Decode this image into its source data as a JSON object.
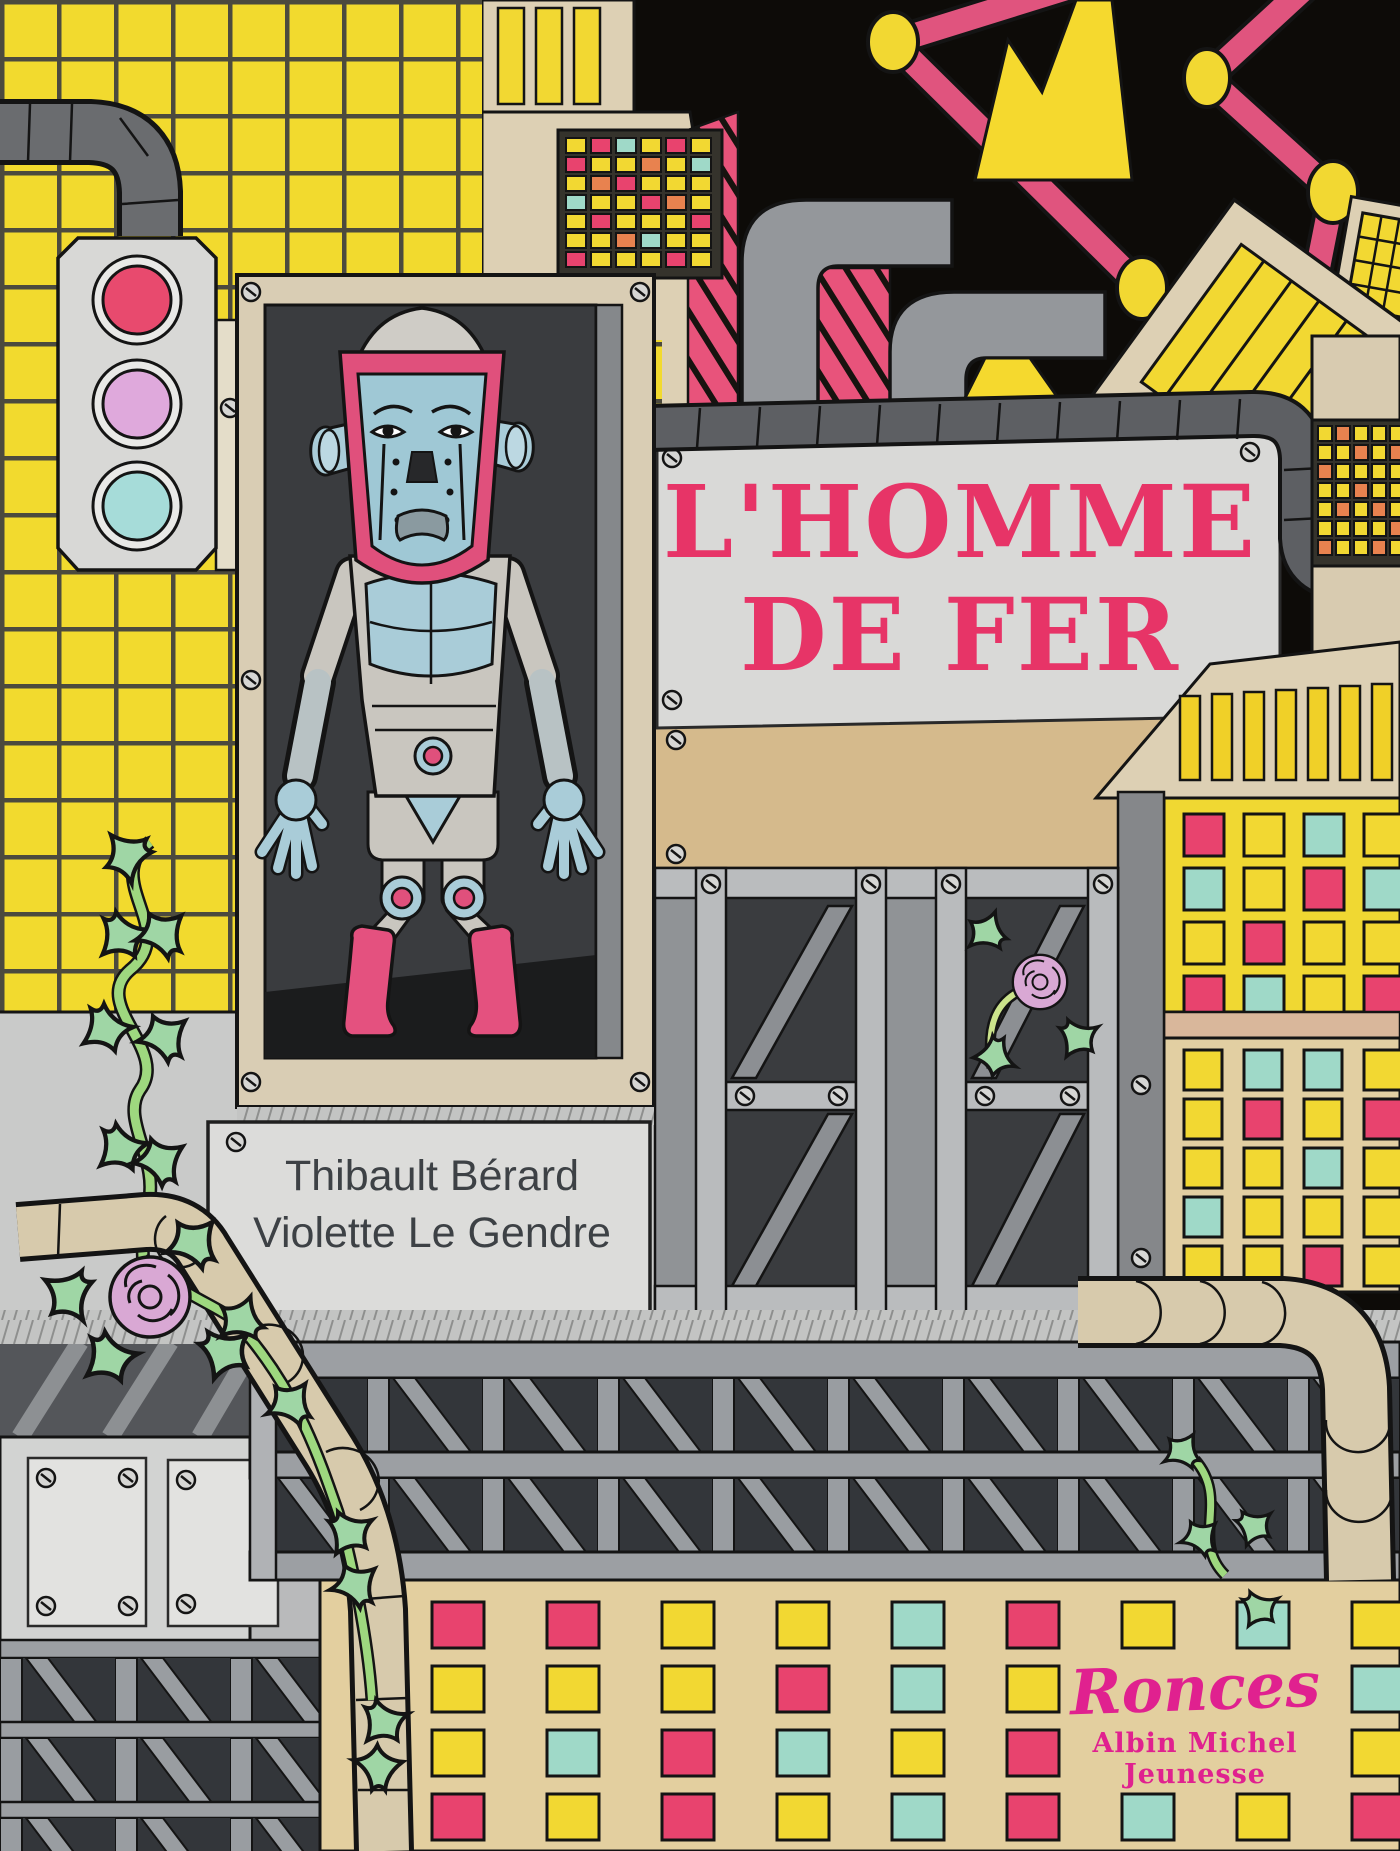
{
  "book_cover": {
    "title": {
      "line1": "L'HOMME",
      "line2": "DE FER"
    },
    "authors": [
      "Thibault Bérard",
      "Violette Le Gendre"
    ],
    "collection_logo": "Ronces",
    "imprint": "Albin Michel Jeunesse",
    "colors": {
      "title_pink": "#e73467",
      "logo_magenta": "#e0218f",
      "author_gray": "#3d4145",
      "accent_yellow": "#f2d832",
      "accent_pink": "#e8436e",
      "accent_teal": "#9fd9c8",
      "traffic_lilac": "#dfa9dc",
      "robot_blue": "#a9ccd8",
      "boot_pink": "#e4517f",
      "wall_beige": "#ddd0b4",
      "sky_black": "#0d0b08"
    }
  },
  "scene": {
    "elements": [
      "yellow-tiled-wall",
      "traffic-light",
      "overhead-pipe",
      "robot-display-cabinet",
      "iron-man-robot",
      "title-sign",
      "factory-chimneys",
      "constellation-crane-arms",
      "tilted-slat-crate",
      "author-name-plate",
      "x-braced-doors",
      "climbing-rose-vine",
      "rose-flowers",
      "steel-truss-bridge",
      "beige-pipes",
      "colored-window-walls",
      "mosaic-tile-panels"
    ],
    "palette_map": {
      "p": "#e8436e",
      "y": "#f2d832",
      "t": "#9fd9c8",
      "o": "#e8824f"
    },
    "square_grids": {
      "bottom-wall": {
        "origin": [
          432,
          1602
        ],
        "cell": [
          52,
          46
        ],
        "step": [
          115,
          64
        ],
        "stroke": 3,
        "rows": [
          [
            "p",
            "p",
            "y",
            "y",
            "t",
            "p",
            "y",
            "t",
            "y"
          ],
          [
            "y",
            "y",
            "y",
            "p",
            "t",
            "y",
            "",
            "",
            "t"
          ],
          [
            "y",
            "t",
            "p",
            "t",
            "y",
            "p",
            "",
            "",
            "y"
          ],
          [
            "p",
            "y",
            "p",
            "y",
            "t",
            "p",
            "t",
            "y",
            "p"
          ]
        ]
      },
      "right-yellow-wall": {
        "origin": [
          1184,
          814
        ],
        "cell": [
          40,
          42
        ],
        "step": [
          60,
          54
        ],
        "stroke": 3,
        "rows": [
          [
            "p",
            "y",
            "t",
            "y"
          ],
          [
            "t",
            "y",
            "p",
            "t"
          ],
          [
            "y",
            "p",
            "y",
            "y"
          ],
          [
            "p",
            "t",
            "y",
            "p"
          ]
        ]
      },
      "right-beige-wall": {
        "origin": [
          1184,
          1050
        ],
        "cell": [
          38,
          40
        ],
        "step": [
          60,
          49
        ],
        "stroke": 3,
        "rows": [
          [
            "y",
            "t",
            "t",
            "y"
          ],
          [
            "y",
            "p",
            "y",
            "p"
          ],
          [
            "y",
            "y",
            "t",
            "y"
          ],
          [
            "t",
            "y",
            "y",
            "y"
          ],
          [
            "y",
            "y",
            "p",
            "y"
          ]
        ]
      },
      "tower-mosaic": {
        "origin": [
          566,
          138
        ],
        "cell": [
          20,
          15
        ],
        "step": [
          25,
          19
        ],
        "stroke": 2,
        "rows": [
          [
            "y",
            "p",
            "t",
            "y",
            "p",
            "y"
          ],
          [
            "p",
            "y",
            "y",
            "o",
            "y",
            "t"
          ],
          [
            "y",
            "o",
            "p",
            "y",
            "y",
            "y"
          ],
          [
            "t",
            "y",
            "y",
            "p",
            "o",
            "y"
          ],
          [
            "y",
            "p",
            "y",
            "y",
            "y",
            "p"
          ],
          [
            "y",
            "y",
            "o",
            "t",
            "y",
            "y"
          ],
          [
            "p",
            "y",
            "y",
            "y",
            "p",
            "y"
          ]
        ]
      },
      "right-mosaic": {
        "origin": [
          1318,
          426
        ],
        "cell": [
          14,
          15
        ],
        "step": [
          18,
          19
        ],
        "stroke": 2,
        "rows": [
          [
            "y",
            "o",
            "y",
            "y",
            "y"
          ],
          [
            "y",
            "y",
            "o",
            "y",
            "o"
          ],
          [
            "o",
            "y",
            "y",
            "y",
            "y"
          ],
          [
            "y",
            "y",
            "o",
            "y",
            "y"
          ],
          [
            "y",
            "o",
            "y",
            "o",
            "y"
          ],
          [
            "y",
            "y",
            "y",
            "y",
            "o"
          ],
          [
            "o",
            "y",
            "y",
            "o",
            "y"
          ]
        ]
      }
    }
  }
}
